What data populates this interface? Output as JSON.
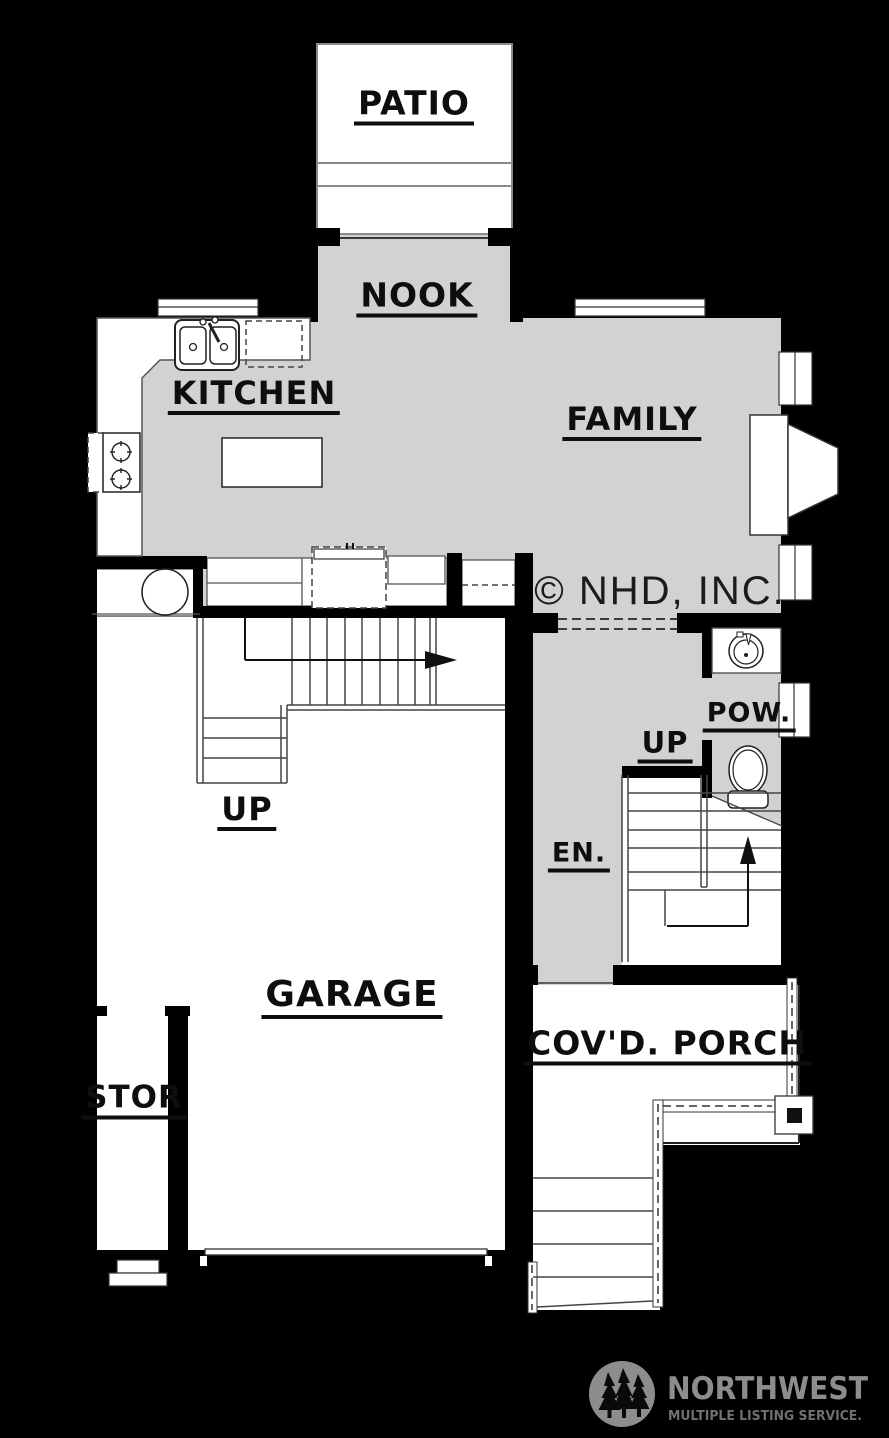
{
  "plan": {
    "labels": {
      "patio": "PATIO",
      "nook": "NOOK",
      "kitchen": "KITCHEN",
      "family": "FAMILY",
      "up_garage": "UP",
      "up_entry": "UP",
      "powder": "POW.",
      "entry": "EN.",
      "garage": "GARAGE",
      "storage": "STOR",
      "covered_porch": "COV'D. PORCH"
    },
    "copyright": "© NHD, INC.",
    "colors": {
      "background": "#000000",
      "floor_gray": "#d2d2d2",
      "room_white": "#ffffff",
      "wall_black": "#000000",
      "detail_line": "#3a3a3a",
      "label_text": "#0e0e0e"
    },
    "fixture_icons": [
      "kitchen-sink-icon",
      "dishwasher-icon",
      "range-icon",
      "island-icon",
      "refrigerator-icon",
      "water-heater-icon",
      "fireplace-icon",
      "powder-sink-icon",
      "toilet-icon",
      "stairs-icon",
      "porch-post-icon",
      "garage-door-icon"
    ]
  },
  "logo": {
    "title": "NORTHWEST",
    "subtitle": "MULTIPLE LISTING SERVICE.",
    "color": "#8d8d8d",
    "icon": "pine-trees-icon"
  }
}
